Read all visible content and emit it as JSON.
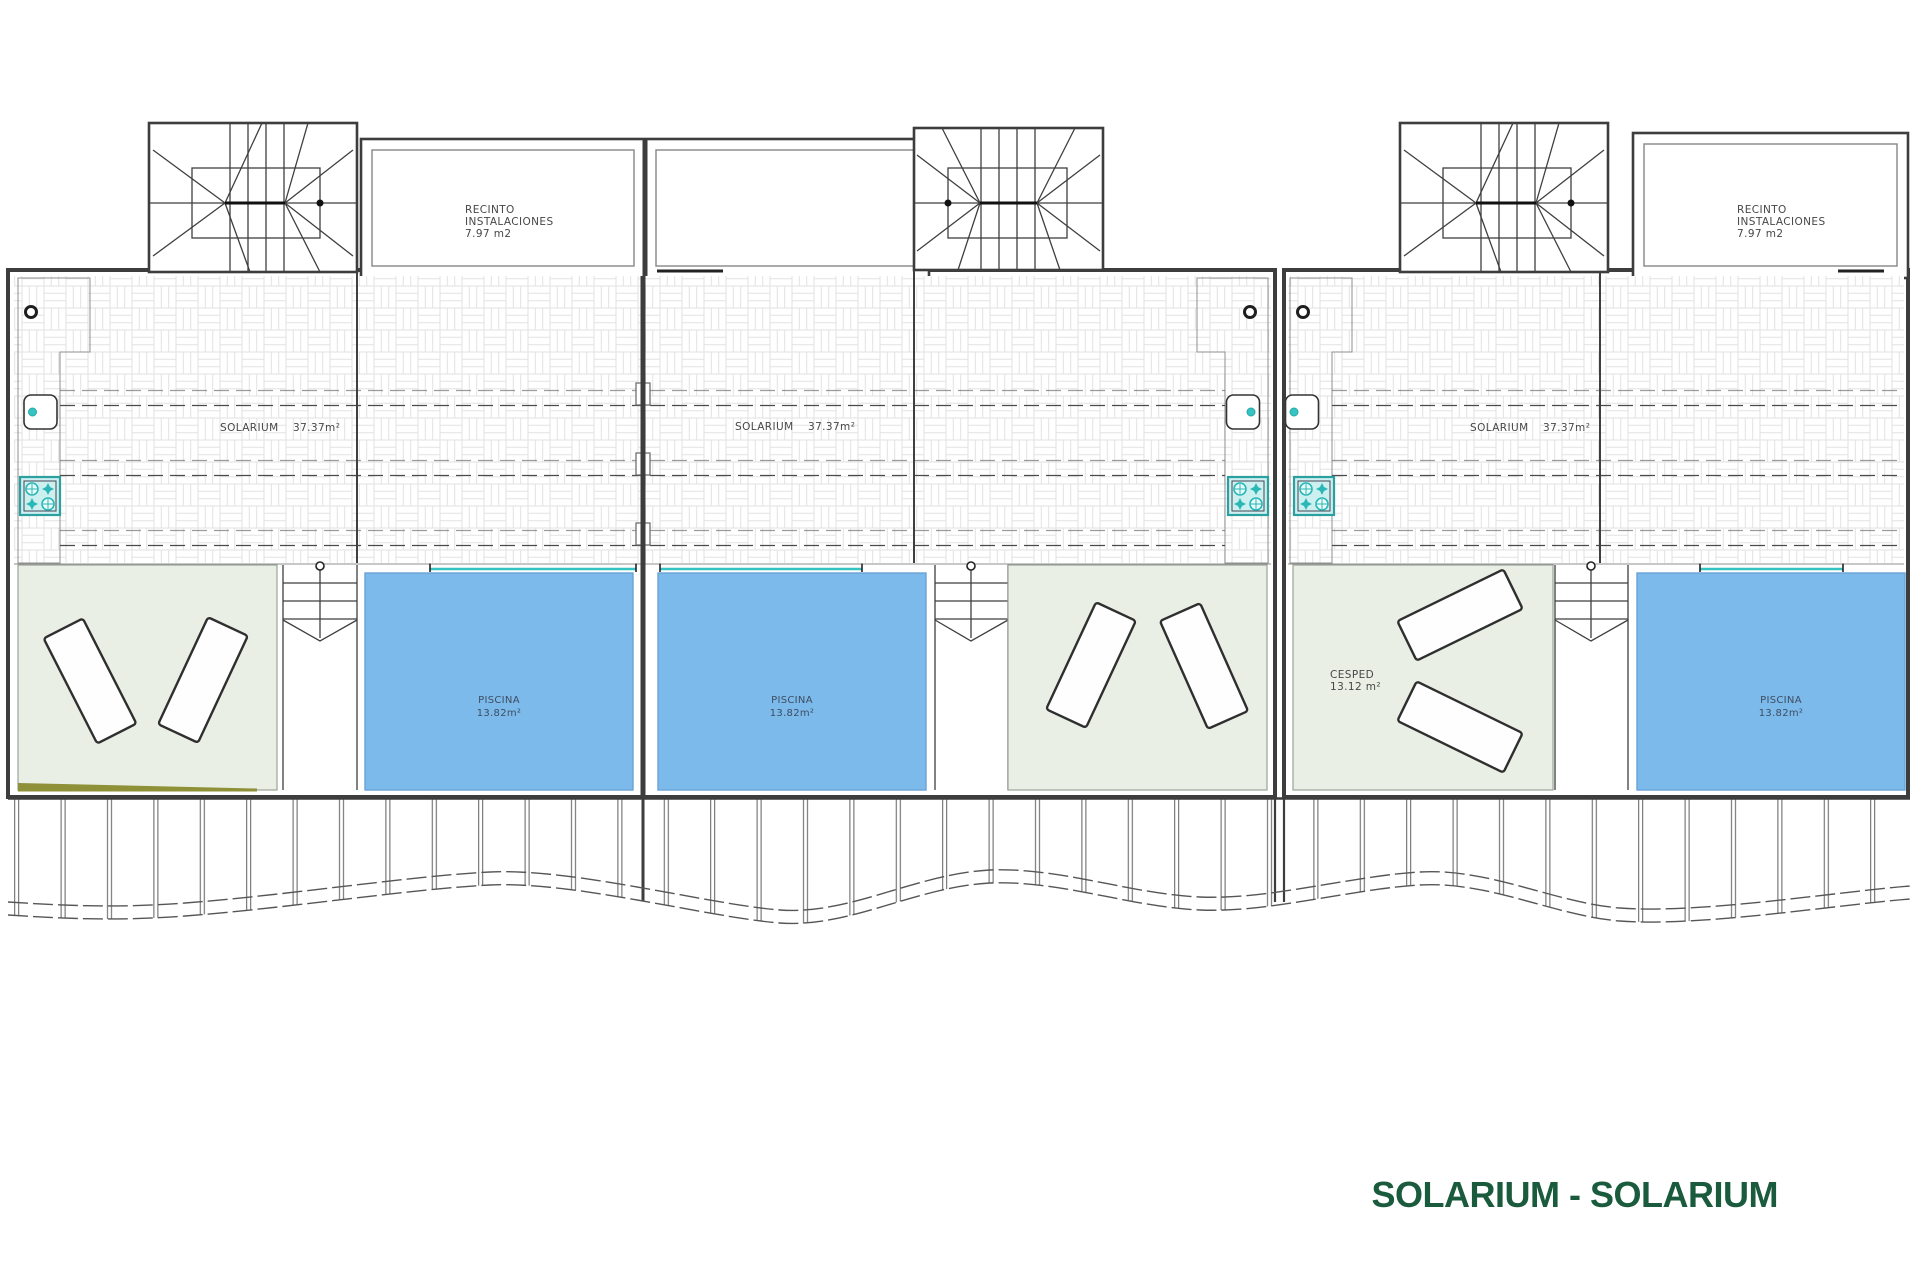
{
  "title": {
    "text": "SOLARIUM - SOLARIUM",
    "color": "#1A5B3D"
  },
  "colors": {
    "pool_blue": "#7CBAEB",
    "lawn_green": "#E9EFE5",
    "teal_fixture": "#35C4C4",
    "olive_strip": "#8E9138",
    "title_green": "#1A5B3D"
  },
  "icons": {
    "grill": "teal-4-burner-grill",
    "sink": "rounded-square-sink-with-teal-tap",
    "light": "small-ring-light",
    "stair_arrow": "down-v-arrow"
  },
  "units": [
    {
      "name": "unit-1",
      "recinto": {
        "line1": "RECINTO",
        "line2": "INSTALACIONES",
        "area": "7.97 m2"
      },
      "solarium": {
        "label": "SOLARIUM",
        "area": "37.37m²"
      },
      "piscina": {
        "label": "PISCINA",
        "area": "13.82m²"
      }
    },
    {
      "name": "unit-2",
      "solarium": {
        "label": "SOLARIUM",
        "area": "37.37m²"
      },
      "piscina": {
        "label": "PISCINA",
        "area": "13.82m²"
      }
    },
    {
      "name": "unit-3",
      "recinto": {
        "line1": "RECINTO",
        "line2": "INSTALACIONES",
        "area": "7.97 m2"
      },
      "solarium": {
        "label": "SOLARIUM",
        "area": "37.37m²"
      },
      "piscina": {
        "label": "PISCINA",
        "area": "13.82m²"
      },
      "cesped": {
        "label": "CESPED",
        "area": "13.12 m²"
      }
    }
  ]
}
